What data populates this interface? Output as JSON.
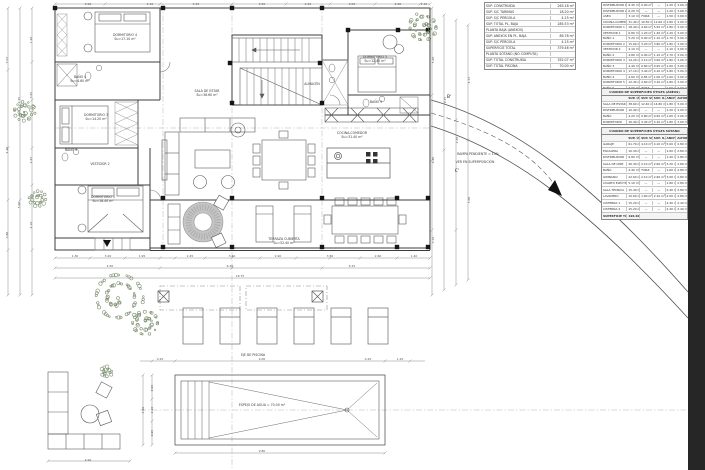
{
  "sheet": {
    "type": "architectural-floor-plan",
    "colors": {
      "line": "#3c3c3c",
      "dim_text": "#555555",
      "greenery": "#7d9070",
      "dark_edge": "#262626",
      "hatch_gray": "#c4c4c4"
    }
  },
  "tables": {
    "a": {
      "rows": [
        [
          "SUP. CONSTRUIDA",
          "263.18 m²"
        ],
        [
          "SUP. S/C TARIMAS",
          "18.20 m²"
        ],
        [
          "SUP. S/C PÉRGOLA",
          "4.15 m²"
        ],
        [
          "SUP. TOTAL PL. BAJA",
          "285.53 m²"
        ],
        [
          "PLANTA BAJA (ANEXOS)",
          ""
        ],
        [
          "SUP. ANEXOS EN PL. BAJA",
          "89.78 m²"
        ],
        [
          "SUP. S/C PÉRGOLA",
          "4.15 m²"
        ],
        [
          "SUPERFICIE TOTAL",
          "379.46 m²"
        ],
        [
          "PLANTA SÓTANO (NO COMPUTA)",
          ""
        ],
        [
          "SUP. TOTAL CONSTRUIDA",
          "352.07 m²"
        ],
        [
          "SUP. TOTAL PISCINA",
          "70.00 m²"
        ]
      ]
    },
    "b": {
      "rows": [
        [
          "DISTRIBUIDOR 1",
          "8.45 m²",
          "0.00 m²",
          "—",
          "1.20 m",
          "3.00 m"
        ],
        [
          "DISTRIBUIDOR 2",
          "6.20 m²",
          "—",
          "—",
          "1.20 m",
          "3.00 m"
        ],
        [
          "ASEO",
          "3.10 m²",
          "FORZ.",
          "—",
          "1.50 m",
          "3.00 m"
        ],
        [
          "COCINA-COMEDOR",
          "31.40 m²",
          "10.50 m²",
          "12.60 m²",
          "1.80 m",
          "3.00 m"
        ],
        [
          "DORMITORIO 1",
          "18.40 m²",
          "4.60 m²",
          "5.50 m²",
          "1.80 m",
          "3.00 m"
        ],
        [
          "VESTIDOR 1",
          "6.80 m²",
          "1.20 m²",
          "1.40 m²",
          "1.20 m",
          "3.00 m"
        ],
        [
          "BAÑO 1",
          "5.20 m²",
          "0.90 m²",
          "1.10 m²",
          "1.70 m",
          "3.00 m"
        ],
        [
          "DORMITORIO 2",
          "15.60 m²",
          "3.20 m²",
          "3.80 m²",
          "1.80 m",
          "3.00 m"
        ],
        [
          "VESTIDOR 2",
          "4.10 m²",
          "—",
          "—",
          "1.10 m",
          "3.00 m"
        ],
        [
          "BAÑO 2",
          "4.80 m²",
          "0.90 m²",
          "1.10 m²",
          "1.70 m",
          "3.00 m"
        ],
        [
          "DORMITORIO 3",
          "14.20 m²",
          "3.10 m²",
          "3.60 m²",
          "1.80 m",
          "3.00 m"
        ],
        [
          "BAÑO 3",
          "4.40 m²",
          "0.80 m²",
          "0.95 m²",
          "1.60 m",
          "3.00 m"
        ],
        [
          "DORMITORIO 4",
          "17.10 m²",
          "3.40 m²",
          "4.10 m²",
          "1.80 m",
          "3.00 m"
        ],
        [
          "BAÑO 4",
          "4.60 m²",
          "0.85 m²",
          "1.00 m²",
          "1.60 m",
          "3.00 m"
        ],
        [
          "DORMITORIO 5",
          "12.40 m²",
          "2.60 m²",
          "3.10 m²",
          "1.80 m",
          "3.00 m"
        ],
        [
          "BAÑO 5",
          "3.90 m²",
          "FORZ.",
          "—",
          "1.50 m",
          "3.00 m"
        ]
      ],
      "footer": [
        "SUPERFICIE TOTAL",
        "171.85 m²",
        "",
        "",
        "",
        "Cumple"
      ]
    },
    "c1": {
      "title": "CUADRO DE SUPERFICIES ÚTILES (ÁREAS)",
      "header": [
        "",
        "SUP. ÚTIL",
        "SUP. VENT.",
        "SUP. ILUM.",
        "ANCHO",
        "ALTURA"
      ],
      "rows": [
        [
          "SALA DE ESTAR",
          "38.60 m²",
          "12.40 m²",
          "14.80 m²",
          "1.80 m",
          "3.00 m"
        ],
        [
          "DISTRIBUIDOR",
          "10.40 m²",
          "—",
          "—",
          "1.20 m",
          "3.00 m"
        ],
        [
          "BAÑO",
          "4.20 m²",
          "0.80 m²",
          "0.95 m²",
          "1.60 m",
          "3.00 m"
        ],
        [
          "DORMITORIO",
          "16.40 m²",
          "3.40 m²",
          "4.10 m²",
          "1.80 m",
          "3.00 m"
        ]
      ]
    },
    "c2": {
      "title": "CUADRO DE SUPERFICIES ÚTILES SÓTANO",
      "header": [
        "",
        "SUP. ÚTIL",
        "SUP. VENT.",
        "SUP. ILUM.",
        "ANCHO",
        "ALTURA"
      ],
      "rows": [
        [
          "GARAJE",
          "61.70 m²",
          "4.10 m²",
          "4.10 m²",
          "5.00 m",
          "2.80 m"
        ],
        [
          "ESCALERA",
          "10.30 m²",
          "—",
          "—",
          "1.00 m",
          "2.80 m"
        ],
        [
          "DISTRIBUIDOR",
          "9.80 m²",
          "—",
          "—",
          "1.40 m",
          "2.80 m"
        ],
        [
          "SALA DE CINE",
          "26.30 m²",
          "2.10 m²",
          "2.60 m²",
          "3.20 m",
          "2.80 m"
        ],
        [
          "BAÑO",
          "4.40 m²",
          "FORZ.",
          "—",
          "1.60 m",
          "2.80 m"
        ],
        [
          "GIMNASIO",
          "22.60 m²",
          "2.10 m²",
          "2.60 m²",
          "3.00 m",
          "2.80 m"
        ],
        [
          "CUARTO ELÉCTRICO",
          "5.10 m²",
          "—",
          "—",
          "1.80 m",
          "2.80 m"
        ],
        [
          "SALA TÉCNICA",
          "15.40 m²",
          "—",
          "—",
          "2.40 m",
          "2.80 m"
        ],
        [
          "LAVADERO",
          "10.60 m²",
          "1.60 m²",
          "2.10 m²",
          "2.00 m",
          "2.80 m"
        ],
        [
          "CISTERNA 1",
          "15.20 m²",
          "—",
          "—",
          "2.40 m",
          "2.40 m"
        ],
        [
          "CISTERNA 2",
          "15.20 m²",
          "—",
          "—",
          "2.40 m",
          "2.40 m"
        ]
      ],
      "footer": [
        "SUPERFICIE TOTAL",
        "196.60 m²"
      ]
    }
  },
  "plan": {
    "labels": [
      {
        "x": 125,
        "y": 34,
        "l1": "DORMITORIO 4",
        "l2": "Su=17.10 m²"
      },
      {
        "x": 80,
        "y": 76,
        "l1": "BAÑO 4",
        "l2": "Su=4.60 m²"
      },
      {
        "x": 96,
        "y": 114,
        "l1": "DORMITORIO 3",
        "l2": "Su=14.20 m²"
      },
      {
        "x": 71,
        "y": 149,
        "l1": "BAÑO 3",
        "l2": ""
      },
      {
        "x": 100,
        "y": 163,
        "l1": "VESTIDOR 2",
        "l2": ""
      },
      {
        "x": 103,
        "y": 196,
        "l1": "DORMITORIO 1",
        "l2": "Su=18.40 m²"
      },
      {
        "x": 207,
        "y": 90,
        "l1": "SALA DE ESTAR",
        "l2": "Su=38.60 m²"
      },
      {
        "x": 352,
        "y": 132,
        "l1": "COCINA-COMEDOR",
        "l2": "Su=31.40 m²"
      },
      {
        "x": 375,
        "y": 56,
        "l1": "DORMITORIO 5",
        "l2": "Su=12.40 m²"
      },
      {
        "x": 376,
        "y": 101,
        "l1": "BAÑO 5",
        "l2": ""
      },
      {
        "x": 312,
        "y": 83,
        "l1": "ALMACÉN",
        "l2": ""
      },
      {
        "x": 284,
        "y": 238,
        "l1": "TERRAZA CUBIERTA",
        "l2": "Su=52.40 m²"
      },
      {
        "x": 262,
        "y": 404,
        "l1": "ESPEJO DE AGUA = 70.00 m²",
        "l2": ""
      },
      {
        "x": 253,
        "y": 354,
        "l1": "EJE DE PISCINA",
        "l2": ""
      },
      {
        "x": 478,
        "y": 153,
        "l1": "RAMPA PENDIENTE = 15%",
        "l2": ""
      },
      {
        "x": 475,
        "y": 161,
        "l1": "VER EN SUPERPOSICIÓN",
        "l2": ""
      }
    ],
    "markers": [
      {
        "x": 449,
        "y": 95,
        "t": "B'"
      },
      {
        "x": 457,
        "y": 169,
        "t": "C'"
      }
    ],
    "dims": [
      [
        88,
        4,
        "3.90",
        0
      ],
      [
        150,
        4,
        "2.10",
        0
      ],
      [
        196,
        4,
        "5.45",
        0
      ],
      [
        262,
        4,
        "3.50",
        0
      ],
      [
        308,
        4,
        "2.45",
        0
      ],
      [
        352,
        4,
        "3.05",
        0
      ],
      [
        398,
        4,
        "2.60",
        0
      ],
      [
        424,
        4,
        "1.40",
        0
      ],
      [
        7,
        60,
        "3.55",
        1
      ],
      [
        7,
        150,
        "4.20",
        1
      ],
      [
        7,
        235,
        "3.80",
        1
      ],
      [
        19,
        100,
        "7.75",
        1
      ],
      [
        19,
        205,
        "5.90",
        1
      ],
      [
        31,
        40,
        "1.20",
        1
      ],
      [
        31,
        95,
        "3.65",
        1
      ],
      [
        31,
        160,
        "2.45",
        1
      ],
      [
        31,
        225,
        "4.10",
        1
      ],
      [
        75,
        256,
        "1.30",
        0
      ],
      [
        108,
        256,
        "3.20",
        0
      ],
      [
        142,
        256,
        "1.95",
        0
      ],
      [
        190,
        256,
        "2.45",
        0
      ],
      [
        232,
        256,
        "3.40",
        0
      ],
      [
        278,
        256,
        "2.90",
        0
      ],
      [
        330,
        256,
        "3.55",
        0
      ],
      [
        378,
        256,
        "2.60",
        0
      ],
      [
        414,
        256,
        "1.40",
        0
      ],
      [
        110,
        266,
        "4.50",
        0
      ],
      [
        230,
        266,
        "6.30",
        0
      ],
      [
        352,
        266,
        "6.15",
        0
      ],
      [
        240,
        276,
        "18.75",
        0
      ],
      [
        160,
        359,
        "0.25",
        0
      ],
      [
        262,
        359,
        "9.00",
        0
      ],
      [
        368,
        359,
        "0.25",
        0
      ],
      [
        400,
        359,
        "1.25",
        0
      ],
      [
        152,
        388,
        "0.95",
        1
      ],
      [
        152,
        410,
        "2.10",
        1
      ],
      [
        152,
        433,
        "0.95",
        1
      ],
      [
        143,
        410,
        "4.00",
        1
      ],
      [
        262,
        451,
        "9.80",
        0
      ],
      [
        88,
        460,
        "4.90",
        0
      ],
      [
        433,
        60,
        "5.20",
        1
      ],
      [
        433,
        160,
        "6.40",
        1
      ],
      [
        433,
        240,
        "3.10",
        1
      ],
      [
        445,
        100,
        "9.75",
        1
      ],
      [
        457,
        140,
        "2.30",
        1
      ],
      [
        469,
        80,
        "4.15",
        1
      ],
      [
        469,
        200,
        "5.60",
        1
      ]
    ]
  }
}
